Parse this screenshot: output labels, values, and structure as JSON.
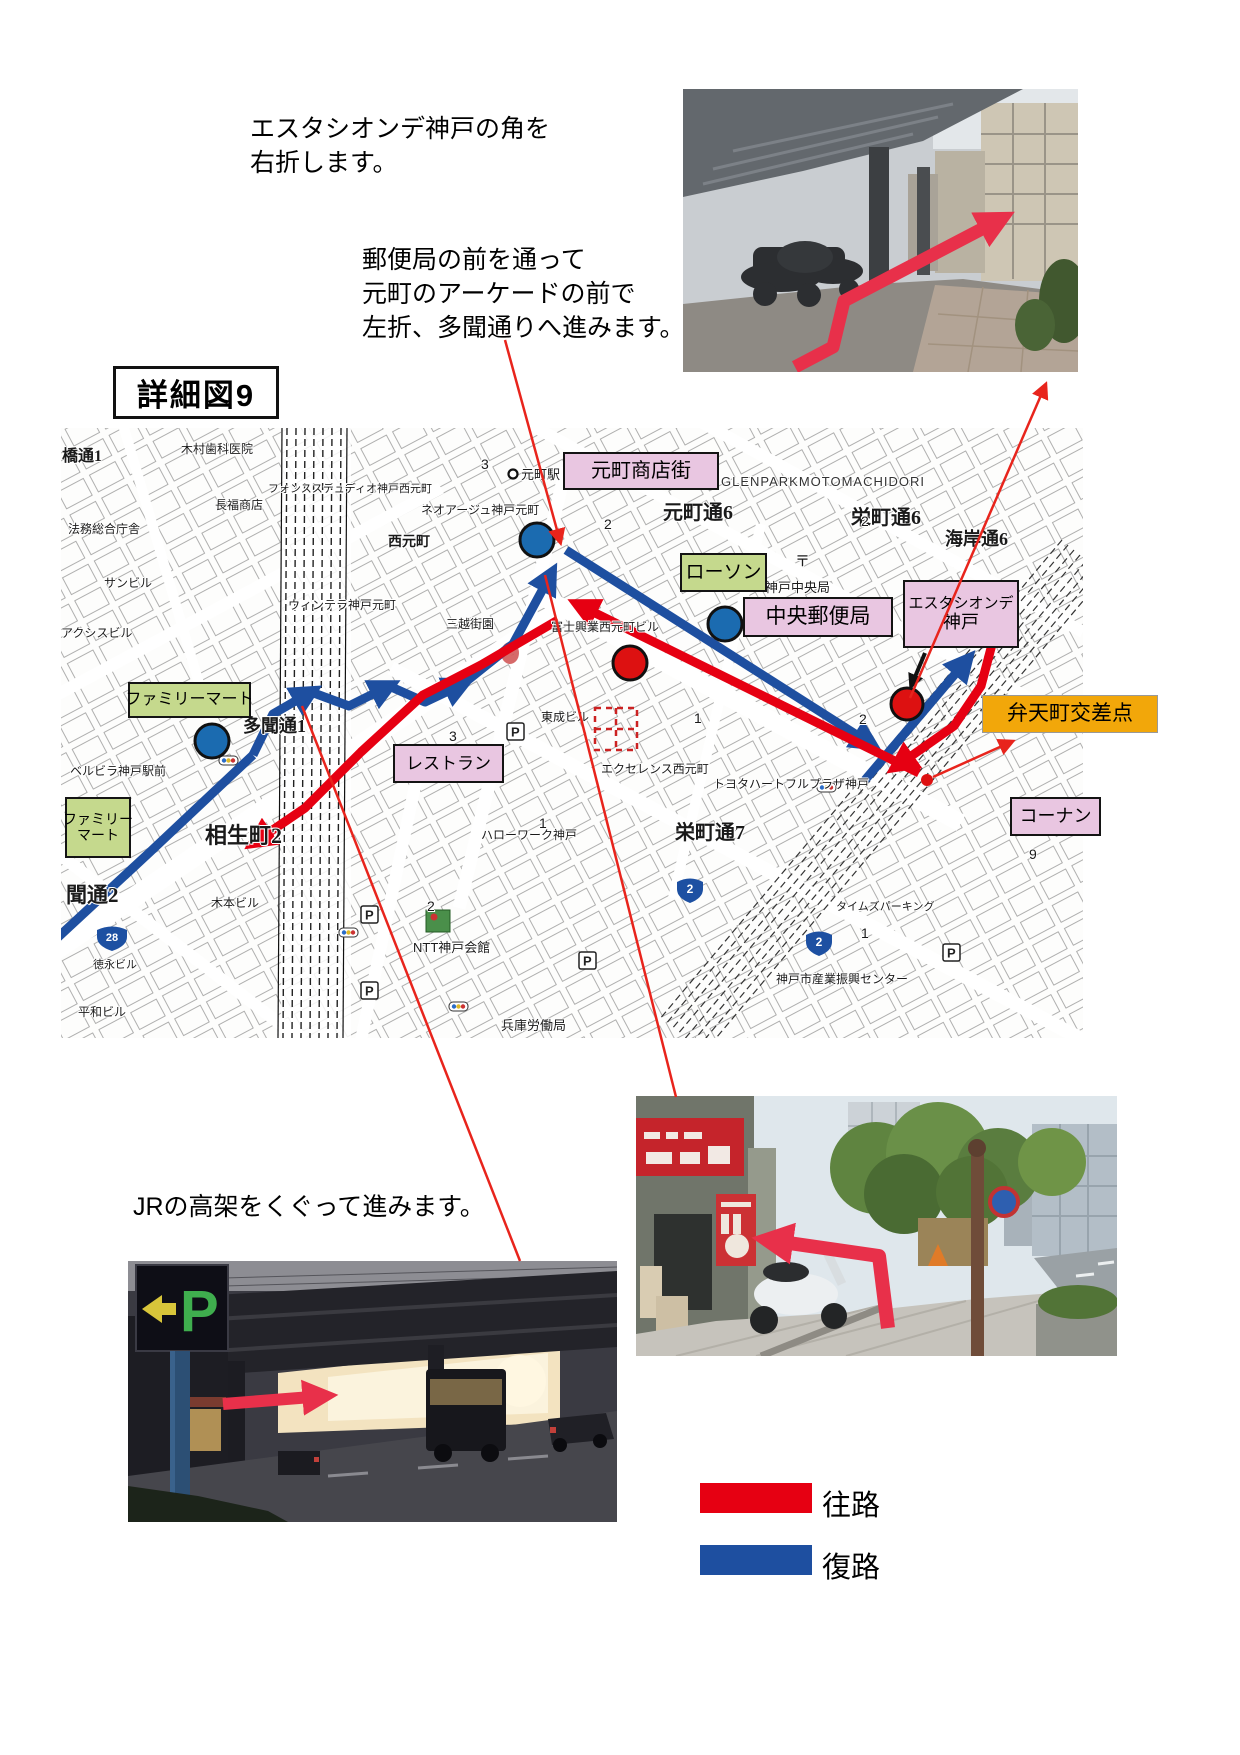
{
  "title": {
    "text": "詳細図9"
  },
  "annotations": {
    "note1": {
      "line1": "エスタシオンデ神戸の角を",
      "line2": "右折します。"
    },
    "note2": {
      "line1": "郵便局の前を通って",
      "line2": "元町のアーケードの前で",
      "line3": "左折、多聞通りへ進みます。"
    },
    "note3": {
      "text": "JRの高架をくぐって進みます。"
    }
  },
  "legend": {
    "outbound": {
      "label": "往路",
      "color": "#E60012"
    },
    "inbound": {
      "label": "復路",
      "color": "#1E4FA0"
    }
  },
  "colors": {
    "outbound": "#E60012",
    "return": "#1E4FA0",
    "leader": "#E8241C",
    "marker_blue": "#1B6BB0",
    "marker_red": "#DD1111",
    "callout_pink": "#E9C6E1",
    "callout_green": "#C5D98D",
    "callout_orange": "#F2A70A",
    "photo_arrow": "#E8304A"
  },
  "map": {
    "callouts": {
      "shotengai": "元町商店街",
      "lawson": "ローソン",
      "post_office": "中央郵便局",
      "estacion_line1": "エスタシオンデ",
      "estacion_line2": "神戸",
      "bentencho": "弁天町交差点",
      "konan": "コーナン",
      "familymart1": "ファミリーマート",
      "restaurant": "レストラン",
      "familymart2_line1": "ファミリー",
      "familymart2_line2": "マート"
    },
    "streets": {
      "motomachi6": "元町通6",
      "sakaemachi6": "栄町通6",
      "kaigan6": "海岸通6",
      "sakaemachi7": "栄町通7",
      "aioicho2": "相生町2",
      "tamon1": "多聞通1",
      "tamon2": "聞通2",
      "hashidori": "橋通1",
      "nishimotomachi": "西元町",
      "motomachi_sta": "元町駅"
    },
    "places": {
      "glenpark": "GLENPARKMOTOMACHIDORI",
      "postal_mark": "〒",
      "kobe_chuo_kyoku": "神戸中央局",
      "neoage": "ネオアージュ神戸元町",
      "fons": "フォンスステュディオ神戸西元町",
      "wintera": "ウィンテラ神戸元町",
      "mitsukoshi_gaien": "三越街園",
      "fuji_kogyo": "富士興業西元町ビル",
      "tosei_bldg": "東成ビル",
      "excellence": "エクセレンス西元町",
      "toyota": "トヨタハートフルプラザ神戸",
      "hellowork": "ハローワーク神戸",
      "ntt_kaikan": "NTT神戸会館",
      "rodo_kyoku": "兵庫労働局",
      "sangyo_center": "神戸市産業振興センター",
      "times": "タイムズパーキング",
      "bellvilla": "ベルビラ神戸駅前",
      "kimoto_bldg": "木本ビル",
      "tokunaga_bldg": "徳永ビル",
      "heiwa_bldg": "平和ビル",
      "homu_chosha": "法務総合庁舎",
      "sun_bldg": "サンビル",
      "axis_bldg": "アクシスビル",
      "kimura_dental": "木村歯科医院",
      "chofuku_shoten": "長福商店"
    },
    "route_shields": {
      "s1": "2",
      "s2": "2",
      "s3": "28"
    },
    "icons": {
      "parking": "P"
    },
    "lot_numbers": {
      "n1": "2",
      "n2": "2",
      "n3": "1",
      "n4": "3",
      "n5": "2",
      "n6": "1",
      "n7": "9",
      "n8": "1",
      "n9": "2",
      "n10": "3"
    }
  }
}
